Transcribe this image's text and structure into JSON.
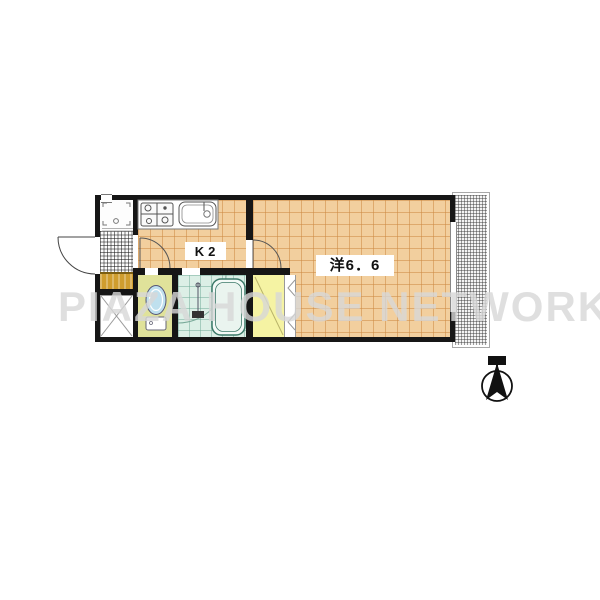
{
  "plan": {
    "kitchen_label": "K2",
    "main_room_label": "洋6．6",
    "watermark_text": "PIAZA HOUSE NETWORK"
  },
  "colors": {
    "wall": "#161616",
    "floor": "#f2cf9e",
    "floor_grid": "#cd8a44",
    "entry_hatch": "#fcfcfc",
    "toilet_room": "#e0e29a",
    "bathroom": "#dcefe6",
    "closet": "#f5f3a3",
    "step": "#cf9d2e",
    "toilet_fixture": "#bfe0ee",
    "watermark": "#d8d8d8",
    "compass": "#111111"
  }
}
